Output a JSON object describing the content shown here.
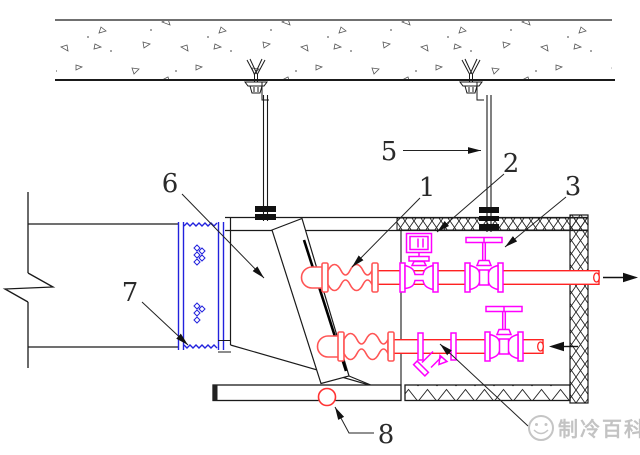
{
  "drawing": {
    "kind": "fan-coil-unit-installation-section",
    "callouts": {
      "c1": "1",
      "c2": "2",
      "c3": "3",
      "c5": "5",
      "c6": "6",
      "c7": "7",
      "c8": "8"
    },
    "flow_arrows": {
      "top_pipe_direction": "right",
      "bottom_pipe_direction": "left"
    },
    "colors": {
      "pipe_red": "#ff2222",
      "hose_red": "#ff5555",
      "valve_magenta": "#ff00ff",
      "duct_connector_blue": "#2222dd",
      "line_black": "#1a1a1a",
      "drain_red": "#ff3333",
      "watermark_gray": "#b9b9b9"
    }
  },
  "watermark": {
    "text": "制冷百科"
  }
}
